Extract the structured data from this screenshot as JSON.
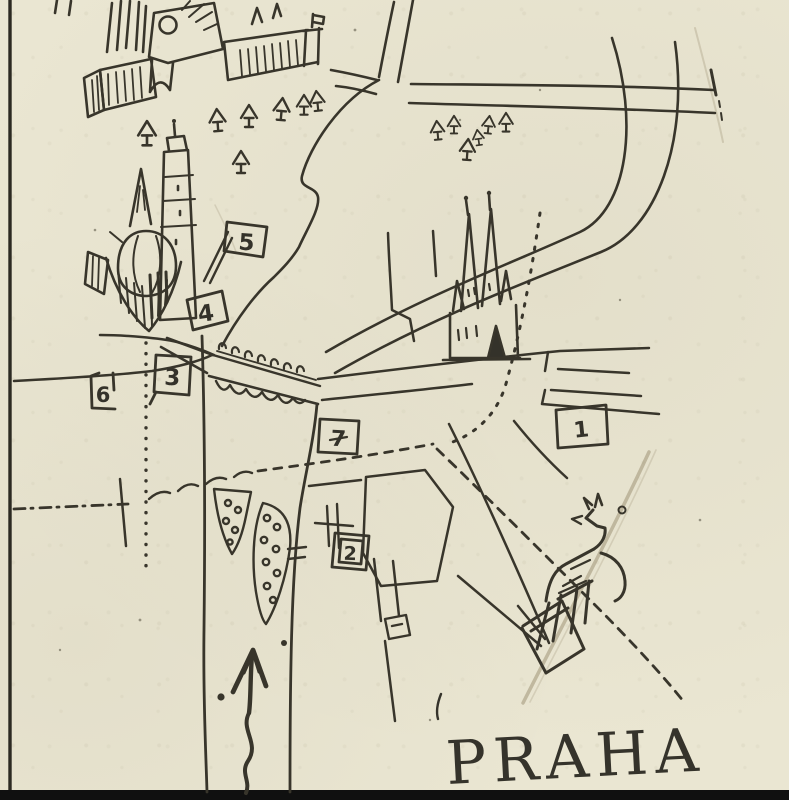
{
  "map": {
    "title": "PRAHA",
    "paper_color": "#eae6d2",
    "ink_color": "#38352b",
    "markers": [
      {
        "label": "1"
      },
      {
        "label": "2"
      },
      {
        "label": "3"
      },
      {
        "label": "4"
      },
      {
        "label": "5"
      },
      {
        "label": "6"
      },
      {
        "label": "7"
      }
    ],
    "landmark_icons": [
      "castle-complex-icon",
      "domed-church-with-tower-icon",
      "twin-spired-church-icon",
      "arched-bridge-with-statues-icon",
      "river-island-with-trees-icon",
      "equestrian-statue-icon",
      "north-arrow-icon",
      "pine-tree-icon",
      "flag-marker-icon"
    ]
  }
}
